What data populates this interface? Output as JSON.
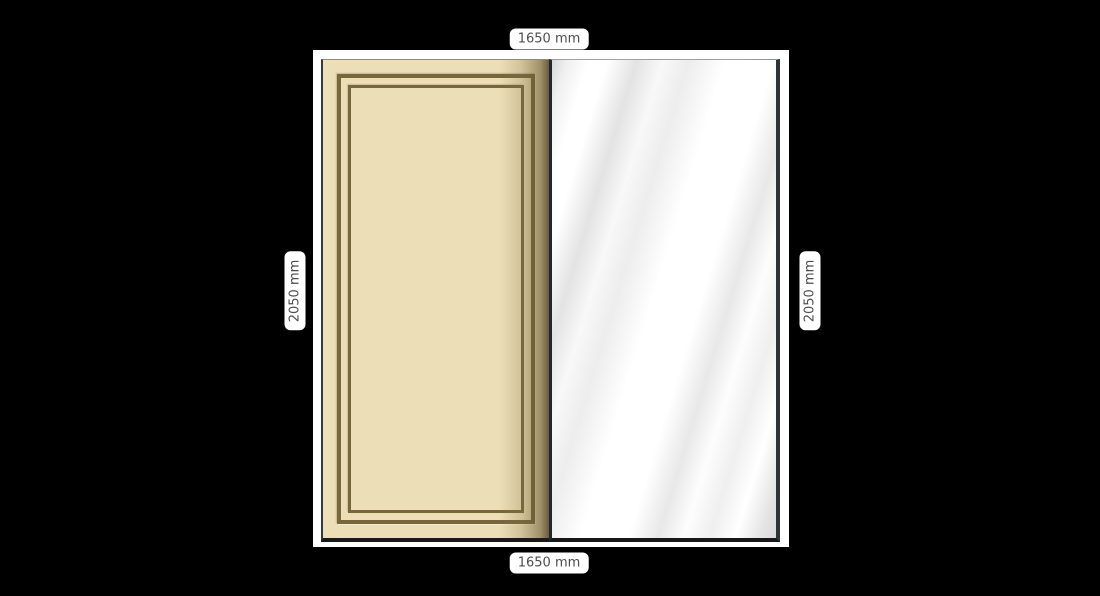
{
  "canvas": {
    "background_color": "#000000"
  },
  "wardrobe": {
    "frame": {
      "color": "#ffffff"
    },
    "doors": [
      {
        "id": "panel-door",
        "style": "cream panel with double molding frame",
        "base_color": "#ecdfb7",
        "molding_color": "#77683c"
      },
      {
        "id": "mirror-door",
        "style": "mirror with diagonal reflection streaks",
        "base_color": "#ffffff",
        "streak_color": "#dcdbdc",
        "edge_color": "#2e343a"
      }
    ]
  },
  "dimensions": {
    "top": "1650 mm",
    "bottom": "1650 mm",
    "left": "2050 mm",
    "right": "2050 mm"
  }
}
